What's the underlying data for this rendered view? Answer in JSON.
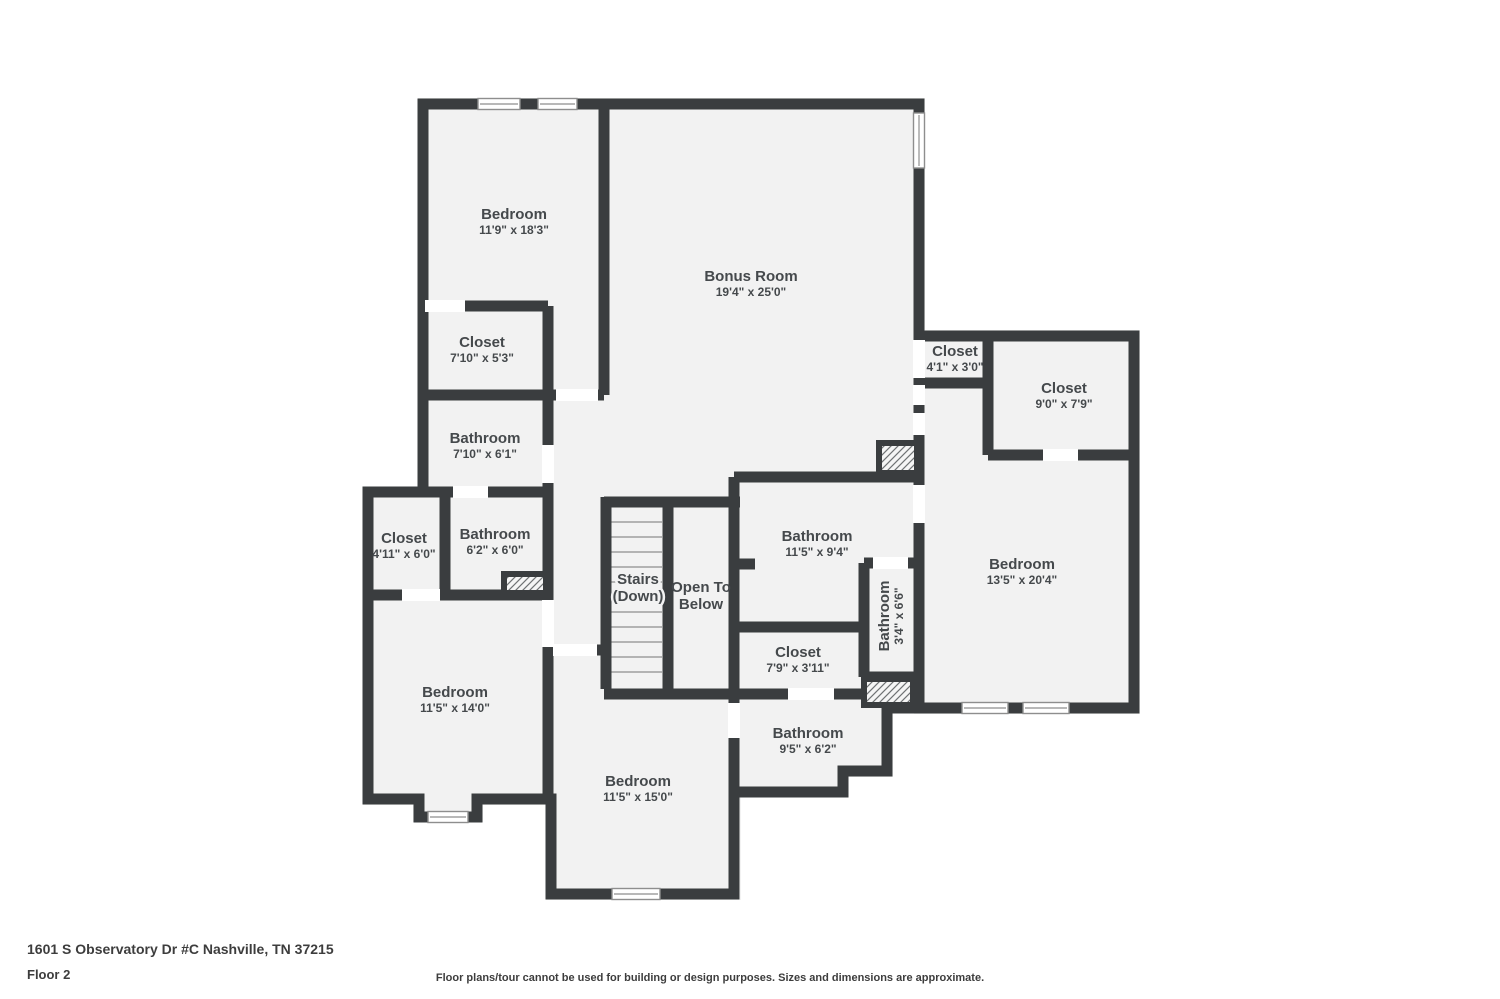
{
  "page": {
    "address": "1601 S Observatory Dr #C Nashville, TN 37215",
    "floor_label": "Floor 2",
    "disclaimer": "Floor plans/tour cannot be used for building or design purposes. Sizes and dimensions are approximate."
  },
  "colors": {
    "wall": "#3a3d3f",
    "room-fill": "#f2f2f2",
    "label": "#45494c",
    "door": "#ffffff",
    "window-frame": "#8e8e8e",
    "stair-tread": "#b3b3b3",
    "footer-text": "#3d3d3d"
  },
  "rooms": [
    {
      "name": "Bedroom",
      "dims": "11'9\" x 18'3\""
    },
    {
      "name": "Bonus Room",
      "dims": "19'4\" x 25'0\""
    },
    {
      "name": "Closet",
      "dims": "7'10\" x 5'3\""
    },
    {
      "name": "Bathroom",
      "dims": "7'10\" x 6'1\""
    },
    {
      "name": "Closet",
      "dims": "4'11\" x 6'0\""
    },
    {
      "name": "Bathroom",
      "dims": "6'2\" x 6'0\""
    },
    {
      "name": "Stairs",
      "dims": "(Down)"
    },
    {
      "name": "Open To",
      "dims": "Below"
    },
    {
      "name": "Bathroom",
      "dims": "11'5\" x 9'4\""
    },
    {
      "name": "Closet",
      "dims": "7'9\" x 3'11\""
    },
    {
      "name": "Bathroom",
      "dims": "3'4\" x 6'6\""
    },
    {
      "name": "Closet",
      "dims": "4'1\" x 3'0\""
    },
    {
      "name": "Closet",
      "dims": "9'0\" x 7'9\""
    },
    {
      "name": "Bedroom",
      "dims": "13'5\" x 20'4\""
    },
    {
      "name": "Bedroom",
      "dims": "11'5\" x 14'0\""
    },
    {
      "name": "Bedroom",
      "dims": "11'5\" x 15'0\""
    },
    {
      "name": "Bathroom",
      "dims": "9'5\" x 6'2\""
    }
  ]
}
